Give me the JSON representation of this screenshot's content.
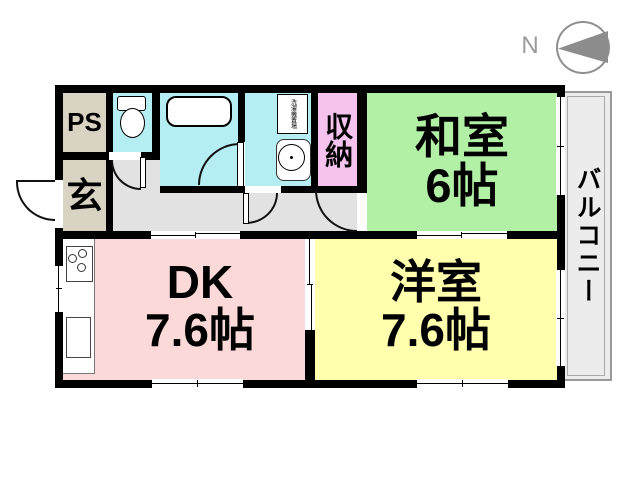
{
  "compass": {
    "north": "N"
  },
  "rooms": {
    "ps": {
      "label": "PS"
    },
    "entrance": {
      "label": "玄"
    },
    "storage": {
      "label": "収納"
    },
    "japanese_room": {
      "name": "和室",
      "size": "6帖"
    },
    "dining_kitchen": {
      "name": "DK",
      "size": "7.6帖"
    },
    "western_room": {
      "name": "洋室",
      "size": "7.6帖"
    },
    "balcony": {
      "label": "バルコニー"
    }
  },
  "fixtures": {
    "laundry": {
      "label": "洗濯機置場"
    }
  },
  "colors": {
    "wall": "#000000",
    "japanese_room": "#b2f0a6",
    "western_room": "#ffffae",
    "dining_kitchen": "#fcd9d9",
    "storage": "#f6c2ee",
    "wet_area": "#b4eef2",
    "service_beige": "#d8d3c3",
    "hallway": "#e2e2e2",
    "balcony": "#ececec",
    "compass_gray": "#8c8c8c"
  }
}
